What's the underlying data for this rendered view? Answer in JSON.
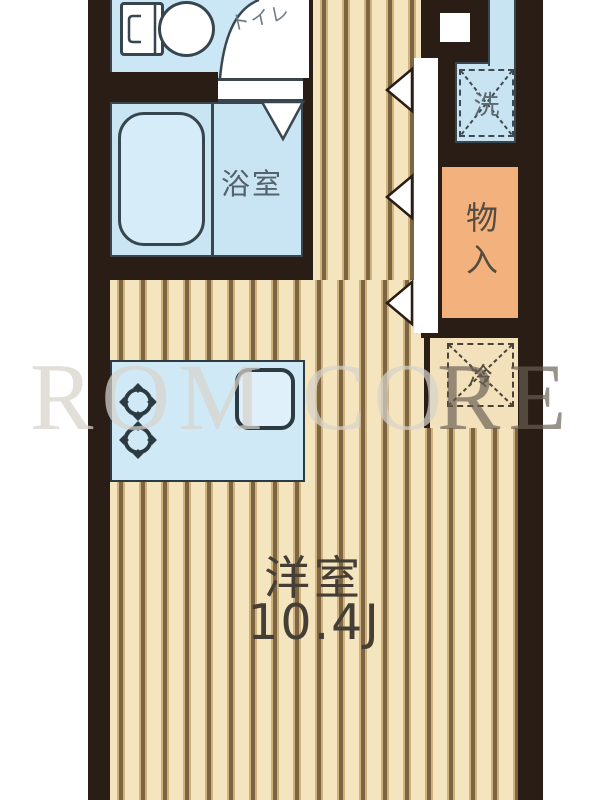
{
  "document": {
    "type": "apartment-floor-plan",
    "orientation": "vertical",
    "size_px": {
      "width": 600,
      "height": 800
    }
  },
  "rooms": {
    "toilet": {
      "label": "トイレ"
    },
    "bathroom": {
      "label": "浴室"
    },
    "washer": {
      "label": "洗"
    },
    "storage": {
      "label": "物入"
    },
    "fridge": {
      "label": "冷"
    },
    "main_room": {
      "label": "洋室",
      "size": "10.4J"
    }
  },
  "fixtures": [
    "toilet-tank",
    "toilet-bowl",
    "bathtub",
    "kitchen-sink",
    "stove-burner",
    "stove-burner",
    "washing-machine-space",
    "refrigerator-space",
    "meter-box"
  ],
  "doors": {
    "toilet_door": "quarter-arc-swing",
    "bathroom_door": "down-triangle",
    "closet_doors": [
      "left-triangle",
      "left-triangle",
      "left-triangle"
    ]
  },
  "watermark": {
    "left": "ROM CO",
    "right": "RE"
  },
  "colors": {
    "wall": "#2a1d15",
    "floor_light": "#f4e5bf",
    "floor_stripe": "#7d6442",
    "water_room_blue": "#c9e5f3",
    "fixture_line": "#36454e",
    "closet_orange": "#f3b17d",
    "fridge_niche_beige": "#f2e1ba",
    "label_dark": "#453e35",
    "label_blue_gray": "#55626c"
  }
}
